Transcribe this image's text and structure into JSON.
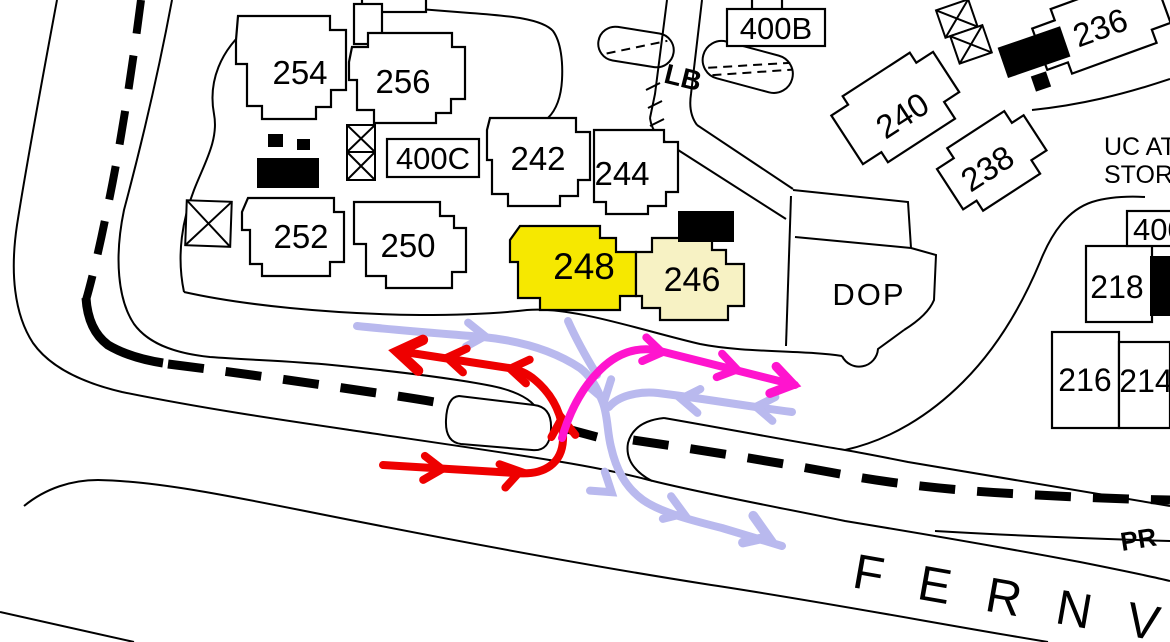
{
  "labels": {
    "b254": "254",
    "b256": "256",
    "b252": "252",
    "b250": "250",
    "b242": "242",
    "b244": "244",
    "b248": "248",
    "b246": "246",
    "b240": "240",
    "b238": "238",
    "b236": "236",
    "b218": "218",
    "b216": "216",
    "b214": "214",
    "box_400b": "400B",
    "box_400c": "400C",
    "box_400_right": "400",
    "lb": "LB",
    "dop": "DOP",
    "uc_line1": "UC AT",
    "uc_line2": "STOR",
    "street_main": "FERNV",
    "street_secondary": "PR"
  },
  "colors": {
    "background": "#ffffff",
    "line": "#000000",
    "route_red": "#ee0000",
    "route_magenta": "#ff14ce",
    "route_purple": "#b9b9ee",
    "building_248_fill": "#f6e800",
    "building_246_fill": "#f7f2c4"
  }
}
